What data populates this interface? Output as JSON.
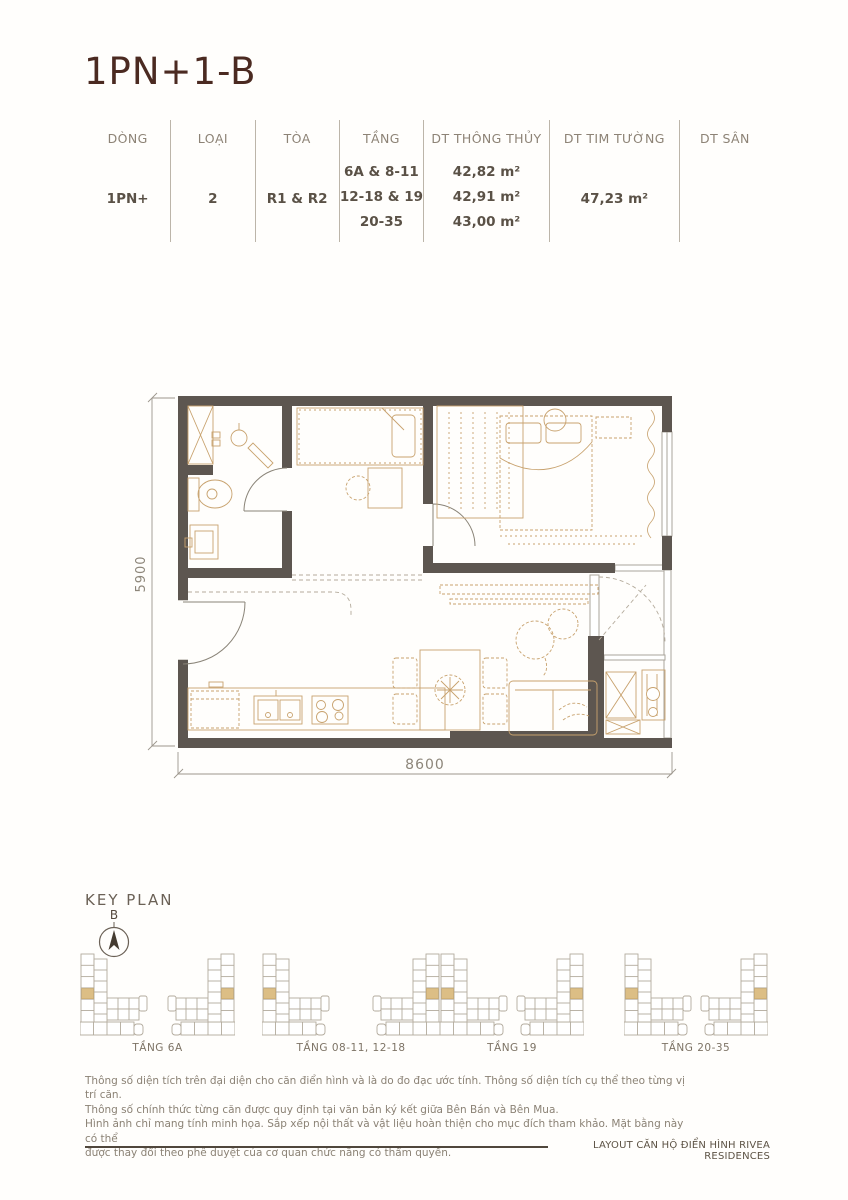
{
  "page": {
    "title": "1PN+1-B"
  },
  "table": {
    "headers": [
      "DÒNG",
      "LOẠI",
      "TÒA",
      "TẦNG",
      "DT THÔNG THỦY",
      "DT TIM TƯỜNG",
      "DT SÂN"
    ],
    "row": {
      "dong": "1PN+",
      "loai": "2",
      "toa": "R1 & R2",
      "tang": [
        "6A & 8-11",
        "12-18 & 19",
        "20-35"
      ],
      "dt_thong_thuy": [
        "42,82 m²",
        "42,91 m²",
        "43,00 m²"
      ],
      "dt_tim_tuong": "47,23 m²",
      "dt_san": ""
    }
  },
  "floor_plan": {
    "height_label": "5900",
    "width_label": "8600"
  },
  "key_plan": {
    "title": "KEY PLAN",
    "compass_label": "B",
    "floors": [
      {
        "label": "TẦNG 6A"
      },
      {
        "label": "TẦNG 08-11, 12-18"
      },
      {
        "label": "TẦNG 19"
      },
      {
        "label": "TẦNG 20-35"
      }
    ]
  },
  "footer": {
    "notes": [
      "Thông số diện tích trên đại diện cho căn điển hình và là do đo đạc ước tính. Thông số diện tích cụ thể theo từng vị trí căn.",
      "Thông số chính thức từng căn được quy định tại văn bản ký kết giữa Bên Bán và Bên Mua.",
      "Hình ảnh chỉ mang tính minh họa. Sắp xếp nội thất và vật liệu hoàn thiện cho mục đích tham khảo. Mặt bằng này có thể",
      "được thay đổi theo phê duyệt của cơ quan chức năng có thẩm quyền."
    ],
    "caption": "LAYOUT CĂN HỘ ĐIỂN HÌNH RIVEA RESIDENCES"
  },
  "colors": {
    "wall": "#5d5650",
    "furniture_line": "#c8a26e",
    "structure_line": "#aaa49b",
    "highlight": "#dcbe85",
    "title_text": "#4b2a21",
    "body_text": "#5a5146"
  }
}
